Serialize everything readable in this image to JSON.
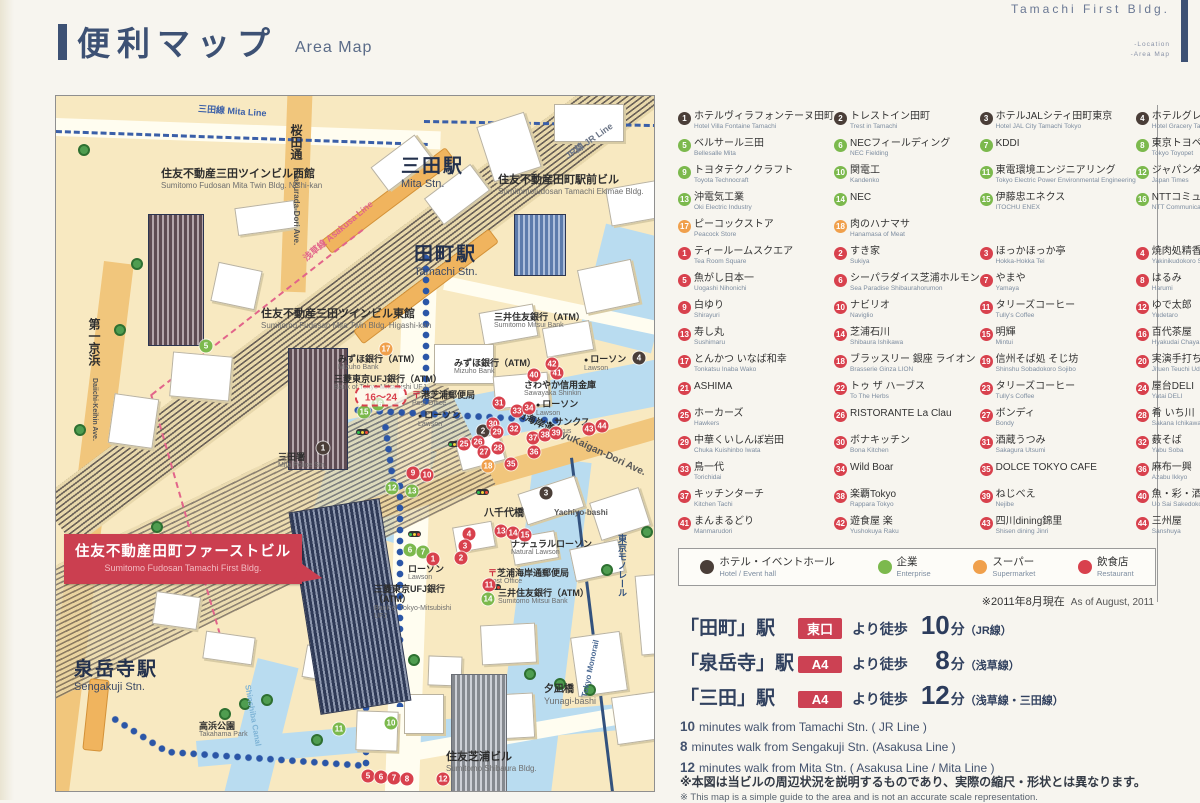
{
  "page": {
    "title_jp": "便利マップ",
    "title_en": "Area Map",
    "building_name": "Tamachi First Bldg.",
    "nav_location": "-Location",
    "nav_areamap": "-Area Map"
  },
  "legend": {
    "colors": {
      "h": "#4a3e38",
      "e": "#7cb94d",
      "s": "#f0a04c",
      "r": "#d8414d"
    },
    "hotel": [
      {
        "n": "1",
        "jp": "ホテルヴィラフォンテーヌ田町",
        "en": "Hotel Villa Fontaine Tamachi"
      },
      {
        "n": "2",
        "jp": "トレストイン田町",
        "en": "Trest in Tamachi"
      },
      {
        "n": "3",
        "jp": "ホテルJALシティ田町東京",
        "en": "Hotel JAL City Tamachi Tokyo"
      },
      {
        "n": "4",
        "jp": "ホテルグレイスリー田町",
        "en": "Hotel Gracery Tamachi"
      }
    ],
    "enterprise": [
      {
        "n": "5",
        "jp": "ベルサール三田",
        "en": "Bellesalle Mita"
      },
      {
        "n": "6",
        "jp": "NECフィールディング",
        "en": "NEC Fielding"
      },
      {
        "n": "7",
        "jp": "KDDI",
        "en": ""
      },
      {
        "n": "8",
        "jp": "東京トヨペット",
        "en": "Tokyo Toyopet"
      },
      {
        "n": "9",
        "jp": "トヨタテクノクラフト",
        "en": "Toyota Technocraft"
      },
      {
        "n": "10",
        "jp": "関電工",
        "en": "Kandenko"
      },
      {
        "n": "11",
        "jp": "東電環境エンジニアリング",
        "en": "Tokyo Electric Power Environmental Engineering"
      },
      {
        "n": "12",
        "jp": "ジャパンタイムズ",
        "en": "Japan Times"
      },
      {
        "n": "13",
        "jp": "沖電気工業",
        "en": "Oki Electric Industry"
      },
      {
        "n": "14",
        "jp": "NEC",
        "en": ""
      },
      {
        "n": "15",
        "jp": "伊藤忠エネクス",
        "en": "ITOCHU ENEX"
      },
      {
        "n": "16",
        "jp": "NTTコミュニケーションズ",
        "en": "NTT Communications"
      }
    ],
    "supermarket": [
      {
        "n": "17",
        "jp": "ピーコックストア",
        "en": "Peacock Store"
      },
      {
        "n": "18",
        "jp": "肉のハナマサ",
        "en": "Hanamasa of Meat"
      }
    ],
    "restaurant": [
      {
        "n": "1",
        "jp": "ティールームスクエア",
        "en": "Tea Room Square"
      },
      {
        "n": "2",
        "jp": "すき家",
        "en": "Sukiya"
      },
      {
        "n": "3",
        "jp": "ほっかほっか亭",
        "en": "Hokka-Hokka Tei"
      },
      {
        "n": "4",
        "jp": "焼肉処精香園",
        "en": "Yakinikudokoro Seikoen"
      },
      {
        "n": "5",
        "jp": "魚がし日本一",
        "en": "Uogashi Nihonichi"
      },
      {
        "n": "6",
        "jp": "シーパラダイス芝浦ホルモン",
        "en": "Sea Paradise Shibaurahorumon"
      },
      {
        "n": "7",
        "jp": "やまや",
        "en": "Yamaya"
      },
      {
        "n": "8",
        "jp": "はるみ",
        "en": "Harumi"
      },
      {
        "n": "9",
        "jp": "白ゆり",
        "en": "Shirayuri"
      },
      {
        "n": "10",
        "jp": "ナビリオ",
        "en": "Naviglio"
      },
      {
        "n": "11",
        "jp": "タリーズコーヒー",
        "en": "Tully's Coffee"
      },
      {
        "n": "12",
        "jp": "ゆで太郎",
        "en": "Yudetaro"
      },
      {
        "n": "13",
        "jp": "寿し丸",
        "en": "Sushimaru"
      },
      {
        "n": "14",
        "jp": "芝浦石川",
        "en": "Shibaura Ishikawa"
      },
      {
        "n": "15",
        "jp": "明輝",
        "en": "Mintui"
      },
      {
        "n": "16",
        "jp": "百代茶屋",
        "en": "Hyakudai Chaya"
      },
      {
        "n": "17",
        "jp": "とんかつ いなば和幸",
        "en": "Tonkatsu Inaba Wako"
      },
      {
        "n": "18",
        "jp": "ブラッスリー 銀座 ライオン",
        "en": "Brasserie Ginza LION"
      },
      {
        "n": "19",
        "jp": "信州そば処 そじ坊",
        "en": "Shinshu Sobadokoro Sojibo"
      },
      {
        "n": "20",
        "jp": "実演手打ちうどん 杵屋",
        "en": "Jituen Teuchi Udon Kineya"
      },
      {
        "n": "21",
        "jp": "ASHIMA",
        "en": ""
      },
      {
        "n": "22",
        "jp": "トゥ ザ ハーブス",
        "en": "To The Herbs"
      },
      {
        "n": "23",
        "jp": "タリーズコーヒー",
        "en": "Tully's Coffee"
      },
      {
        "n": "24",
        "jp": "屋台DELI",
        "en": "Yatai DELI"
      },
      {
        "n": "25",
        "jp": "ホーカーズ",
        "en": "Hawkers"
      },
      {
        "n": "26",
        "jp": "RISTORANTE La Clau",
        "en": ""
      },
      {
        "n": "27",
        "jp": "ボンディ",
        "en": "Bondy"
      },
      {
        "n": "28",
        "jp": "肴 いち川",
        "en": "Sakana Ichikawa"
      },
      {
        "n": "29",
        "jp": "中華くいしんぼ岩田",
        "en": "Chuka Kuishinbo Iwata"
      },
      {
        "n": "30",
        "jp": "ボナキッチン",
        "en": "Bona Kitchen"
      },
      {
        "n": "31",
        "jp": "酒蔵うつみ",
        "en": "Sakagura Utsumi"
      },
      {
        "n": "32",
        "jp": "薮そば",
        "en": "Yabu Soba"
      },
      {
        "n": "33",
        "jp": "鳥一代",
        "en": "Torichidai"
      },
      {
        "n": "34",
        "jp": "Wild Boar",
        "en": ""
      },
      {
        "n": "35",
        "jp": "DOLCE TOKYO CAFE",
        "en": ""
      },
      {
        "n": "36",
        "jp": "麻布一興",
        "en": "Azabu Ikkyo"
      },
      {
        "n": "37",
        "jp": "キッチンターチ",
        "en": "Kitchen Tachi"
      },
      {
        "n": "38",
        "jp": "楽覇Tokyo",
        "en": "Rappara Tokyo"
      },
      {
        "n": "39",
        "jp": "ねじべえ",
        "en": "Nejibe"
      },
      {
        "n": "40",
        "jp": "魚・彩・酒処ふじや",
        "en": "Uo Sai Sakedokoro Fujiya"
      },
      {
        "n": "41",
        "jp": "まんまるどり",
        "en": "Manmarudori"
      },
      {
        "n": "42",
        "jp": "遊食屋 楽",
        "en": "Yushokuya Raku"
      },
      {
        "n": "43",
        "jp": "四川dining錦里",
        "en": "Shisen dining Jinri"
      },
      {
        "n": "44",
        "jp": "三州屋",
        "en": "Sanshuya"
      }
    ],
    "categories": [
      {
        "jp": "ホテル・イベントホール",
        "en": "Hotel / Event hall",
        "color": "#4a3e38"
      },
      {
        "jp": "企業",
        "en": "Enterprise",
        "color": "#7cb94d"
      },
      {
        "jp": "スーパー",
        "en": "Supermarket",
        "color": "#f0a04c"
      },
      {
        "jp": "飲食店",
        "en": "Restaurant",
        "color": "#d8414d"
      }
    ],
    "as_of_jp": "※2011年8月現在",
    "as_of_en": "As of August, 2011"
  },
  "access": {
    "routes": [
      {
        "station": "「田町」駅",
        "exit": "東口",
        "mid": "より徒歩",
        "min": "10",
        "unit": "分",
        "line": "（JR線）"
      },
      {
        "station": "「泉岳寺」駅",
        "exit": "A4",
        "mid": "より徒歩",
        "min": "8",
        "unit": "分",
        "line": "（浅草線）"
      },
      {
        "station": "「三田」駅",
        "exit": "A4",
        "mid": "より徒歩",
        "min": "12",
        "unit": "分",
        "line": "（浅草線・三田線）"
      }
    ],
    "en_lines": [
      {
        "num": "10",
        "text": "minutes walk from Tamachi Stn.  ( JR Line )"
      },
      {
        "num": "8",
        "text": "minutes walk from Sengakuji Stn.  (Asakusa Line )"
      },
      {
        "num": "12",
        "text": "minutes walk from Mita Stn.  ( Asakusa Line / Mita Line )"
      }
    ],
    "note_jp": "※本図は当ビルの周辺状況を説明するものであり、実際の縮尺・形状とは異なります。",
    "note_en": "※ This map is a simple guide to the area and is not an accurate scale representation."
  },
  "map": {
    "post_mark": "〒",
    "range_label": "16〜24",
    "labels": {
      "mita_line": {
        "jp": "三田線",
        "en": "Mita Line"
      },
      "sakurada": {
        "jp": "桜田通",
        "en": "Sakurada-Dori Ave."
      },
      "asakusa": {
        "jp": "浅草線",
        "en": "Asakusa Line"
      },
      "jr": {
        "jp": "JR線",
        "en": "JR Line"
      },
      "mita_stn": {
        "jp": "三田駅",
        "en": "Mita Stn."
      },
      "tamachi_stn": {
        "jp": "田町駅",
        "en": "Tamachi Stn."
      },
      "ekimae": {
        "jp": "住友不動産田町駅前ビル",
        "en": "Sumitomofudosan Tamachi Ekimae Bldg."
      },
      "twin_west": {
        "jp": "住友不動産三田ツインビル西館",
        "en": "Sumitomo Fudosan Mita Twin Bldg. Nishi-kan"
      },
      "twin_east": {
        "jp": "住友不動産三田ツインビル東館",
        "en": "Sumitomo Fudosan Mita Twin Bldg. Higashi-kan"
      },
      "daiichi": {
        "jp": "第一京浜",
        "en": "Daiichi-Keihin Ave."
      },
      "mizuho": {
        "jp": "みずほ銀行（ATM）",
        "en": "Mizuho Bank"
      },
      "ufj": {
        "jp": "三菱東京UFJ銀行（ATM）",
        "en": "Bank of Tokyo-Mitsubishi UFJ"
      },
      "smbc": {
        "jp": "三井住友銀行（ATM）",
        "en": "Sumitomo Mitsui Bank"
      },
      "post1": {
        "jp": "港芝浦郵便局",
        "en": "Post Office"
      },
      "post2": {
        "jp": "芝浦海岸通郵便局",
        "en": "Post Office"
      },
      "sawayaka": {
        "jp": "さわやか信用金庫",
        "en": "Sawayaka Shinkin"
      },
      "lawson": {
        "jp": "ローソン",
        "en": "Lawson"
      },
      "natural_lawson": {
        "jp": "ナチュラルローソン",
        "en": "Natural Lawson"
      },
      "sunkus": {
        "jp": "サンクス",
        "en": "Sunkus"
      },
      "police": {
        "jp": "三田署",
        "en": "Mita Police Stn."
      },
      "kyukaigan": {
        "jp": "旧海岸通",
        "en": "KyuKaigan-Dori Ave."
      },
      "yachiyo": {
        "jp": "八千代橋",
        "en": "Yachiyo-bashi"
      },
      "yunagi": {
        "jp": "夕凪橋",
        "en": "Yunagi-bashi"
      },
      "monorail": {
        "jp": "東京モノレール",
        "en": "Tokyo Monorail"
      },
      "sengakuji": {
        "jp": "泉岳寺駅",
        "en": "Sengakuji Stn."
      },
      "takahama": {
        "jp": "高浜公園",
        "en": "Takahama Park"
      },
      "shibaura_bldg": {
        "jp": "住友芝浦ビル",
        "en": "Sumitomo Shibaura Bldg."
      },
      "shinshiba": {
        "jp": "新芝運河",
        "en": "Shinshiba Canal"
      },
      "first_bldg": {
        "jp": "住友不動産田町ファーストビル",
        "en": "Sumitomo Fudosan Tamachi First Bldg."
      }
    },
    "markers": [
      {
        "n": "1",
        "c": "h",
        "x": 267,
        "y": 352
      },
      {
        "n": "2",
        "c": "h",
        "x": 427,
        "y": 335
      },
      {
        "n": "3",
        "c": "h",
        "x": 490,
        "y": 397
      },
      {
        "n": "4",
        "c": "h",
        "x": 583,
        "y": 262
      },
      {
        "n": "5",
        "c": "e",
        "x": 150,
        "y": 250
      },
      {
        "n": "15",
        "c": "e",
        "x": 308,
        "y": 316
      },
      {
        "n": "16",
        "c": "e",
        "x": 322,
        "y": 308
      },
      {
        "n": "12",
        "c": "e",
        "x": 336,
        "y": 392
      },
      {
        "n": "13",
        "c": "e",
        "x": 356,
        "y": 395
      },
      {
        "n": "6",
        "c": "e",
        "x": 354,
        "y": 454
      },
      {
        "n": "7",
        "c": "e",
        "x": 367,
        "y": 456
      },
      {
        "n": "14",
        "c": "e",
        "x": 432,
        "y": 503
      },
      {
        "n": "10",
        "c": "e",
        "x": 335,
        "y": 627
      },
      {
        "n": "11",
        "c": "e",
        "x": 283,
        "y": 633
      },
      {
        "n": "17",
        "c": "s",
        "x": 330,
        "y": 253
      },
      {
        "n": "18",
        "c": "s",
        "x": 432,
        "y": 370
      },
      {
        "n": "9",
        "c": "r",
        "x": 357,
        "y": 377
      },
      {
        "n": "10",
        "c": "r",
        "x": 371,
        "y": 379
      },
      {
        "n": "31",
        "c": "r",
        "x": 443,
        "y": 307
      },
      {
        "n": "33",
        "c": "r",
        "x": 461,
        "y": 315
      },
      {
        "n": "34",
        "c": "r",
        "x": 473,
        "y": 312
      },
      {
        "n": "30",
        "c": "r",
        "x": 437,
        "y": 328
      },
      {
        "n": "29",
        "c": "r",
        "x": 441,
        "y": 336
      },
      {
        "n": "32",
        "c": "r",
        "x": 458,
        "y": 333
      },
      {
        "n": "25",
        "c": "r",
        "x": 408,
        "y": 348
      },
      {
        "n": "26",
        "c": "r",
        "x": 422,
        "y": 346
      },
      {
        "n": "27",
        "c": "r",
        "x": 428,
        "y": 356
      },
      {
        "n": "28",
        "c": "r",
        "x": 442,
        "y": 352
      },
      {
        "n": "37",
        "c": "r",
        "x": 477,
        "y": 342
      },
      {
        "n": "38",
        "c": "r",
        "x": 489,
        "y": 339
      },
      {
        "n": "39",
        "c": "r",
        "x": 500,
        "y": 337
      },
      {
        "n": "36",
        "c": "r",
        "x": 478,
        "y": 356
      },
      {
        "n": "35",
        "c": "r",
        "x": 455,
        "y": 368
      },
      {
        "n": "43",
        "c": "r",
        "x": 533,
        "y": 333
      },
      {
        "n": "44",
        "c": "r",
        "x": 546,
        "y": 330
      },
      {
        "n": "40",
        "c": "r",
        "x": 478,
        "y": 279
      },
      {
        "n": "41",
        "c": "r",
        "x": 501,
        "y": 277
      },
      {
        "n": "42",
        "c": "r",
        "x": 496,
        "y": 268
      },
      {
        "n": "13",
        "c": "r",
        "x": 445,
        "y": 435
      },
      {
        "n": "14",
        "c": "r",
        "x": 457,
        "y": 437
      },
      {
        "n": "15",
        "c": "r",
        "x": 469,
        "y": 439
      },
      {
        "n": "11",
        "c": "r",
        "x": 433,
        "y": 489
      },
      {
        "n": "4",
        "c": "r",
        "x": 413,
        "y": 438
      },
      {
        "n": "3",
        "c": "r",
        "x": 409,
        "y": 450
      },
      {
        "n": "2",
        "c": "r",
        "x": 405,
        "y": 462
      },
      {
        "n": "1",
        "c": "r",
        "x": 377,
        "y": 463
      },
      {
        "n": "5",
        "c": "r",
        "x": 312,
        "y": 680
      },
      {
        "n": "6",
        "c": "r",
        "x": 325,
        "y": 681
      },
      {
        "n": "7",
        "c": "r",
        "x": 338,
        "y": 682
      },
      {
        "n": "8",
        "c": "r",
        "x": 351,
        "y": 683
      },
      {
        "n": "12",
        "c": "r",
        "x": 387,
        "y": 683
      }
    ]
  }
}
